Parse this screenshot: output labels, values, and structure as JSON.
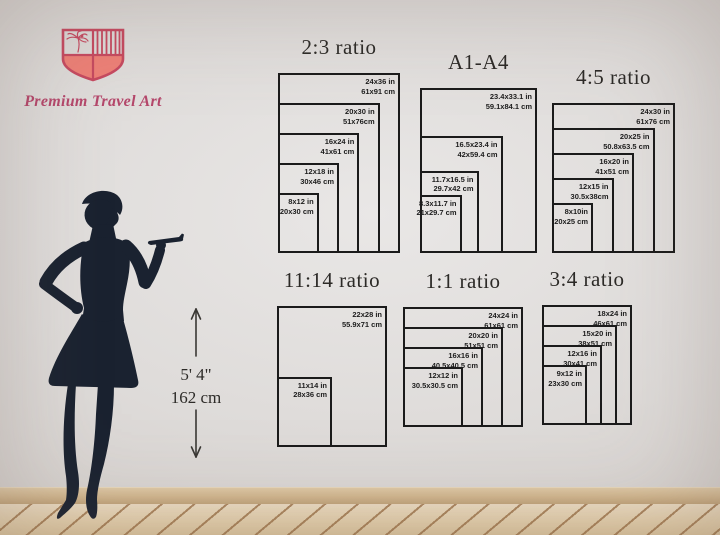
{
  "brand": {
    "name": "Premium Travel Art",
    "logo_icon": "shield-icon",
    "logo_detail_icons": [
      "palm-tree-icon",
      "vertical-stripes"
    ],
    "colors": {
      "shield_outline": "#c64a60",
      "shield_fill": "#ee8077",
      "brand_text": "#b5476b"
    }
  },
  "model": {
    "figure": "woman-silhouette-holding-tray",
    "height_imperial": "5' 4\"",
    "height_metric": "162 cm",
    "silhouette_color": "#1a2230"
  },
  "style": {
    "chart_border_color": "#1b1b1b",
    "label_color": "#1d1d1d",
    "wall_color": "#dedbd9",
    "floor_color": "#e4cfab",
    "baseboard_color": "#d2b78f"
  },
  "charts": [
    {
      "title": "2:3 ratio",
      "sizes": [
        {
          "label_in": "24x36 in",
          "label_cm": "61x91 cm",
          "w_in": 24,
          "h_in": 36
        },
        {
          "label_in": "20x30 in",
          "label_cm": "51x76cm",
          "w_in": 20,
          "h_in": 30
        },
        {
          "label_in": "16x24 in",
          "label_cm": "41x61 cm",
          "w_in": 16,
          "h_in": 24
        },
        {
          "label_in": "12x18 in",
          "label_cm": "30x46 cm",
          "w_in": 12,
          "h_in": 18
        },
        {
          "label_in": "8x12 in",
          "label_cm": "20x30 cm",
          "w_in": 8,
          "h_in": 12
        }
      ]
    },
    {
      "title": "A1-A4",
      "sizes": [
        {
          "label_in": "23.4x33.1 in",
          "label_cm": "59.1x84.1 cm",
          "w_in": 23.4,
          "h_in": 33.1
        },
        {
          "label_in": "16.5x23.4 in",
          "label_cm": "42x59.4 cm",
          "w_in": 16.5,
          "h_in": 23.4
        },
        {
          "label_in": "11.7x16.5 in",
          "label_cm": "29.7x42 cm",
          "w_in": 11.7,
          "h_in": 16.5
        },
        {
          "label_in": "8.3x11.7 in",
          "label_cm": "21x29.7 cm",
          "w_in": 8.3,
          "h_in": 11.7
        }
      ]
    },
    {
      "title": "4:5 ratio",
      "sizes": [
        {
          "label_in": "24x30 in",
          "label_cm": "61x76 cm",
          "w_in": 24,
          "h_in": 30
        },
        {
          "label_in": "20x25 in",
          "label_cm": "50.8x63.5 cm",
          "w_in": 20,
          "h_in": 25
        },
        {
          "label_in": "16x20 in",
          "label_cm": "41x51 cm",
          "w_in": 16,
          "h_in": 20
        },
        {
          "label_in": "12x15 in",
          "label_cm": "30.5x38cm",
          "w_in": 12,
          "h_in": 15
        },
        {
          "label_in": "8x10in",
          "label_cm": "20x25 cm",
          "w_in": 8,
          "h_in": 10
        }
      ]
    },
    {
      "title": "11:14 ratio",
      "sizes": [
        {
          "label_in": "22x28 in",
          "label_cm": "55.9x71 cm",
          "w_in": 22,
          "h_in": 28
        },
        {
          "label_in": "11x14 in",
          "label_cm": "28x36 cm",
          "w_in": 11,
          "h_in": 14
        }
      ]
    },
    {
      "title": "1:1 ratio",
      "sizes": [
        {
          "label_in": "24x24 in",
          "label_cm": "61x61 cm",
          "w_in": 24,
          "h_in": 24
        },
        {
          "label_in": "20x20 in",
          "label_cm": "51x51 cm",
          "w_in": 20,
          "h_in": 20
        },
        {
          "label_in": "16x16 in",
          "label_cm": "40.5x40.5 cm",
          "w_in": 16,
          "h_in": 16
        },
        {
          "label_in": "12x12 in",
          "label_cm": "30.5x30.5 cm",
          "w_in": 12,
          "h_in": 12
        }
      ]
    },
    {
      "title": "3:4 ratio",
      "sizes": [
        {
          "label_in": "18x24 in",
          "label_cm": "46x61 cm",
          "w_in": 18,
          "h_in": 24
        },
        {
          "label_in": "15x20 in",
          "label_cm": "38x51 cm",
          "w_in": 15,
          "h_in": 20
        },
        {
          "label_in": "12x16 in",
          "label_cm": "30x41 cm",
          "w_in": 12,
          "h_in": 16
        },
        {
          "label_in": "9x12 in",
          "label_cm": "23x30 cm",
          "w_in": 9,
          "h_in": 12
        }
      ]
    }
  ]
}
